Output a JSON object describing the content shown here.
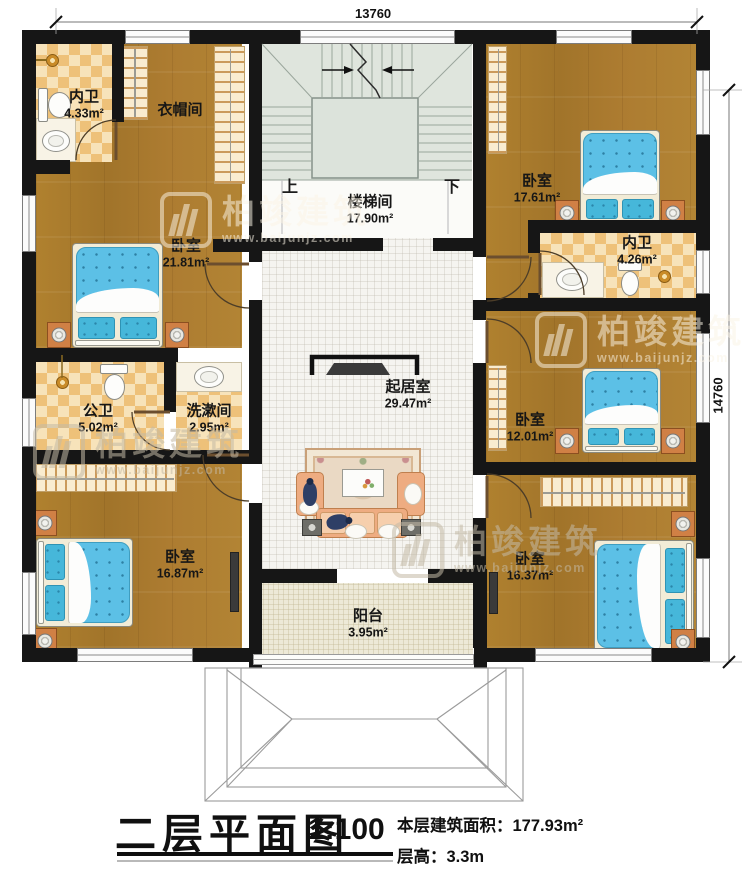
{
  "dimensions": {
    "top": "13760",
    "right": "14760"
  },
  "stairs": {
    "up": "上",
    "down": "下"
  },
  "rooms": {
    "neiwei1": {
      "name": "内卫",
      "area": "4.33m²"
    },
    "yimaojian": {
      "name": "衣帽间"
    },
    "loutijian": {
      "name": "楼梯间",
      "area": "17.90m²"
    },
    "bedroom_tr": {
      "name": "卧室",
      "area": "17.61m²"
    },
    "neiwei2": {
      "name": "内卫",
      "area": "4.26m²"
    },
    "bedroom_ml": {
      "name": "卧室",
      "area": "21.81m²"
    },
    "gongwei": {
      "name": "公卫",
      "area": "5.02m²"
    },
    "xishujian": {
      "name": "洗漱间",
      "area": "2.95m²"
    },
    "qijushi": {
      "name": "起居室",
      "area": "29.47m²"
    },
    "bedroom_mr": {
      "name": "卧室",
      "area": "12.01m²"
    },
    "bedroom_bl": {
      "name": "卧室",
      "area": "16.87m²"
    },
    "bedroom_br": {
      "name": "卧室",
      "area": "16.37m²"
    },
    "yangtai": {
      "name": "阳台",
      "area": "3.95m²"
    }
  },
  "title_block": {
    "title": "二层平面图",
    "scale": "1:100",
    "area_label": "本层建筑面积：177.93m²",
    "height_label": "层高：3.3m"
  },
  "watermark": {
    "brand": "柏竣建筑",
    "url": "www.baijunjz.com"
  },
  "colors": {
    "wall": "#161616",
    "wood": "#ad7c31",
    "tile": "#eec179",
    "bed": "#5cc0e6",
    "accent_wood_furniture": "#d08045"
  }
}
